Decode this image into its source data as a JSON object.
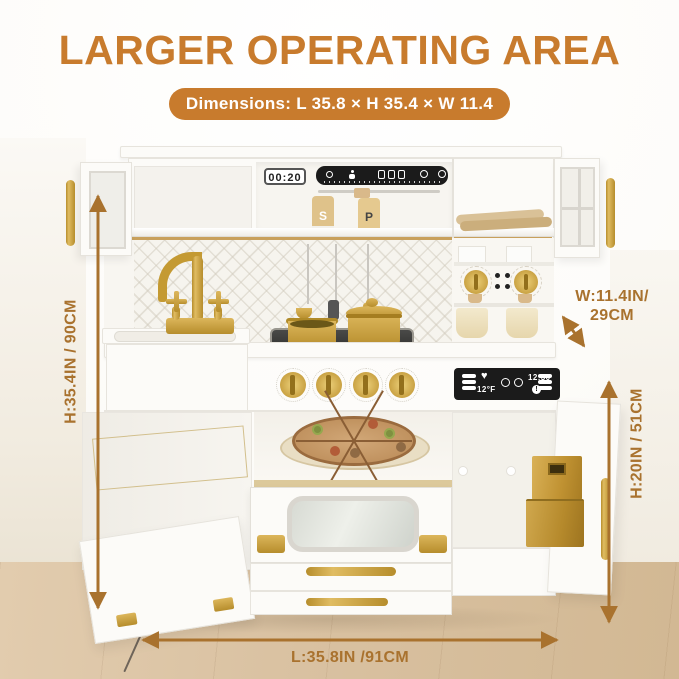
{
  "header": {
    "title": "LARGER OPERATING AREA",
    "badge": "Dimensions: L 35.8 × H 35.4 × W 11.4"
  },
  "dimensions": {
    "height_total": "H:35.4IN / 90CM",
    "depth_line1": "W:11.4IN/",
    "depth_line2": "29CM",
    "height_lower": "H:20IN / 51CM",
    "length": "L:35.8IN /91CM"
  },
  "kitchen": {
    "timer_display": "00:20",
    "salt_label": "S",
    "pepper_label": "P",
    "oven_display": {
      "time": "12:30",
      "temp": "12°F"
    }
  },
  "colors": {
    "accent": "#C87B2D",
    "arrow": "#A9722E",
    "gold": "#C9A23B",
    "gold_dark": "#A9812B",
    "panel_black": "#1B1B1B",
    "wood_floor": "#D9C1A1",
    "kitchen_white": "#FBFAF7"
  }
}
